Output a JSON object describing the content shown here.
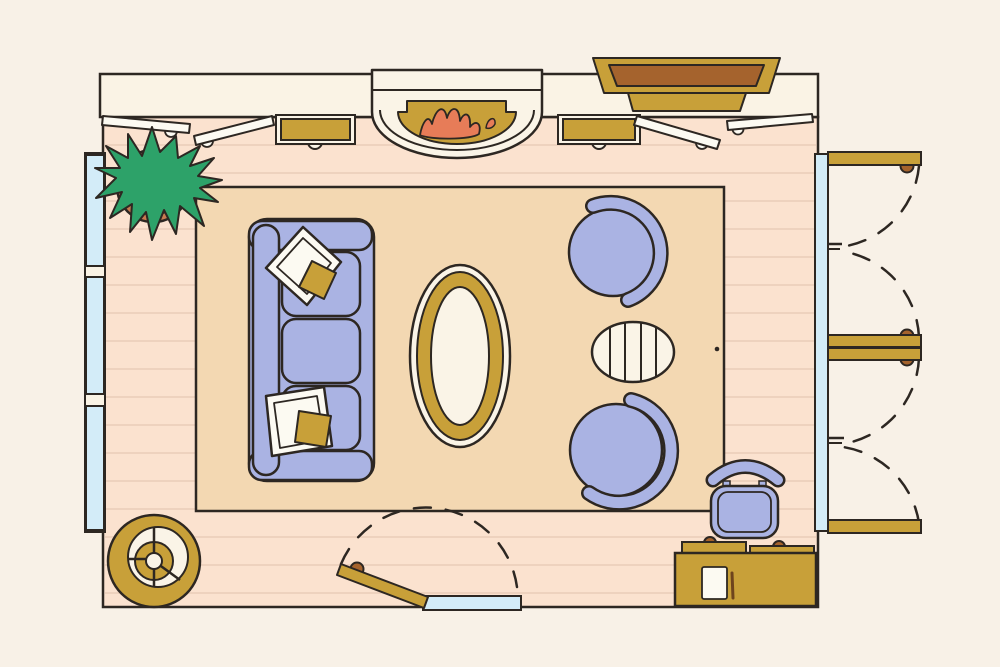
{
  "scene": {
    "kind": "living-room-floor-plan-illustration",
    "objects": [
      "top-wall-with-fireplace",
      "fireplace-with-flames",
      "wall-mounted-tv",
      "wall-console-left",
      "wall-console-right",
      "casement-window-panes",
      "picture-windows-left",
      "glass-wall-right",
      "bifold-doors-right",
      "entry-door-bottom",
      "area-rug",
      "sofa-with-throw-pillows",
      "oval-coffee-table",
      "barrel-armchair-top",
      "barrel-armchair-bottom",
      "striped-ottoman",
      "potted-plant",
      "round-side-table",
      "desk-with-paper-and-pen",
      "desk-chair",
      "desk-drawer-benches"
    ]
  },
  "colors": {
    "background": "#f8f1e7",
    "wall": "#faf3e5",
    "floor": "#fbe2cf",
    "floor_line": "#eccfbc",
    "rug": "#f3d8b2",
    "outline": "#2d2722",
    "gold": "#c8a039",
    "brown": "#a5632d",
    "periwinkle": "#aab3e3",
    "cream": "#faf4e7",
    "pane_white": "#fcfaf2",
    "glass_blue": "#d3ecf8",
    "plant_green": "#2da269",
    "terracotta": "#c97a50",
    "flame": "#e77c58",
    "pen_brown": "#6e441d"
  }
}
